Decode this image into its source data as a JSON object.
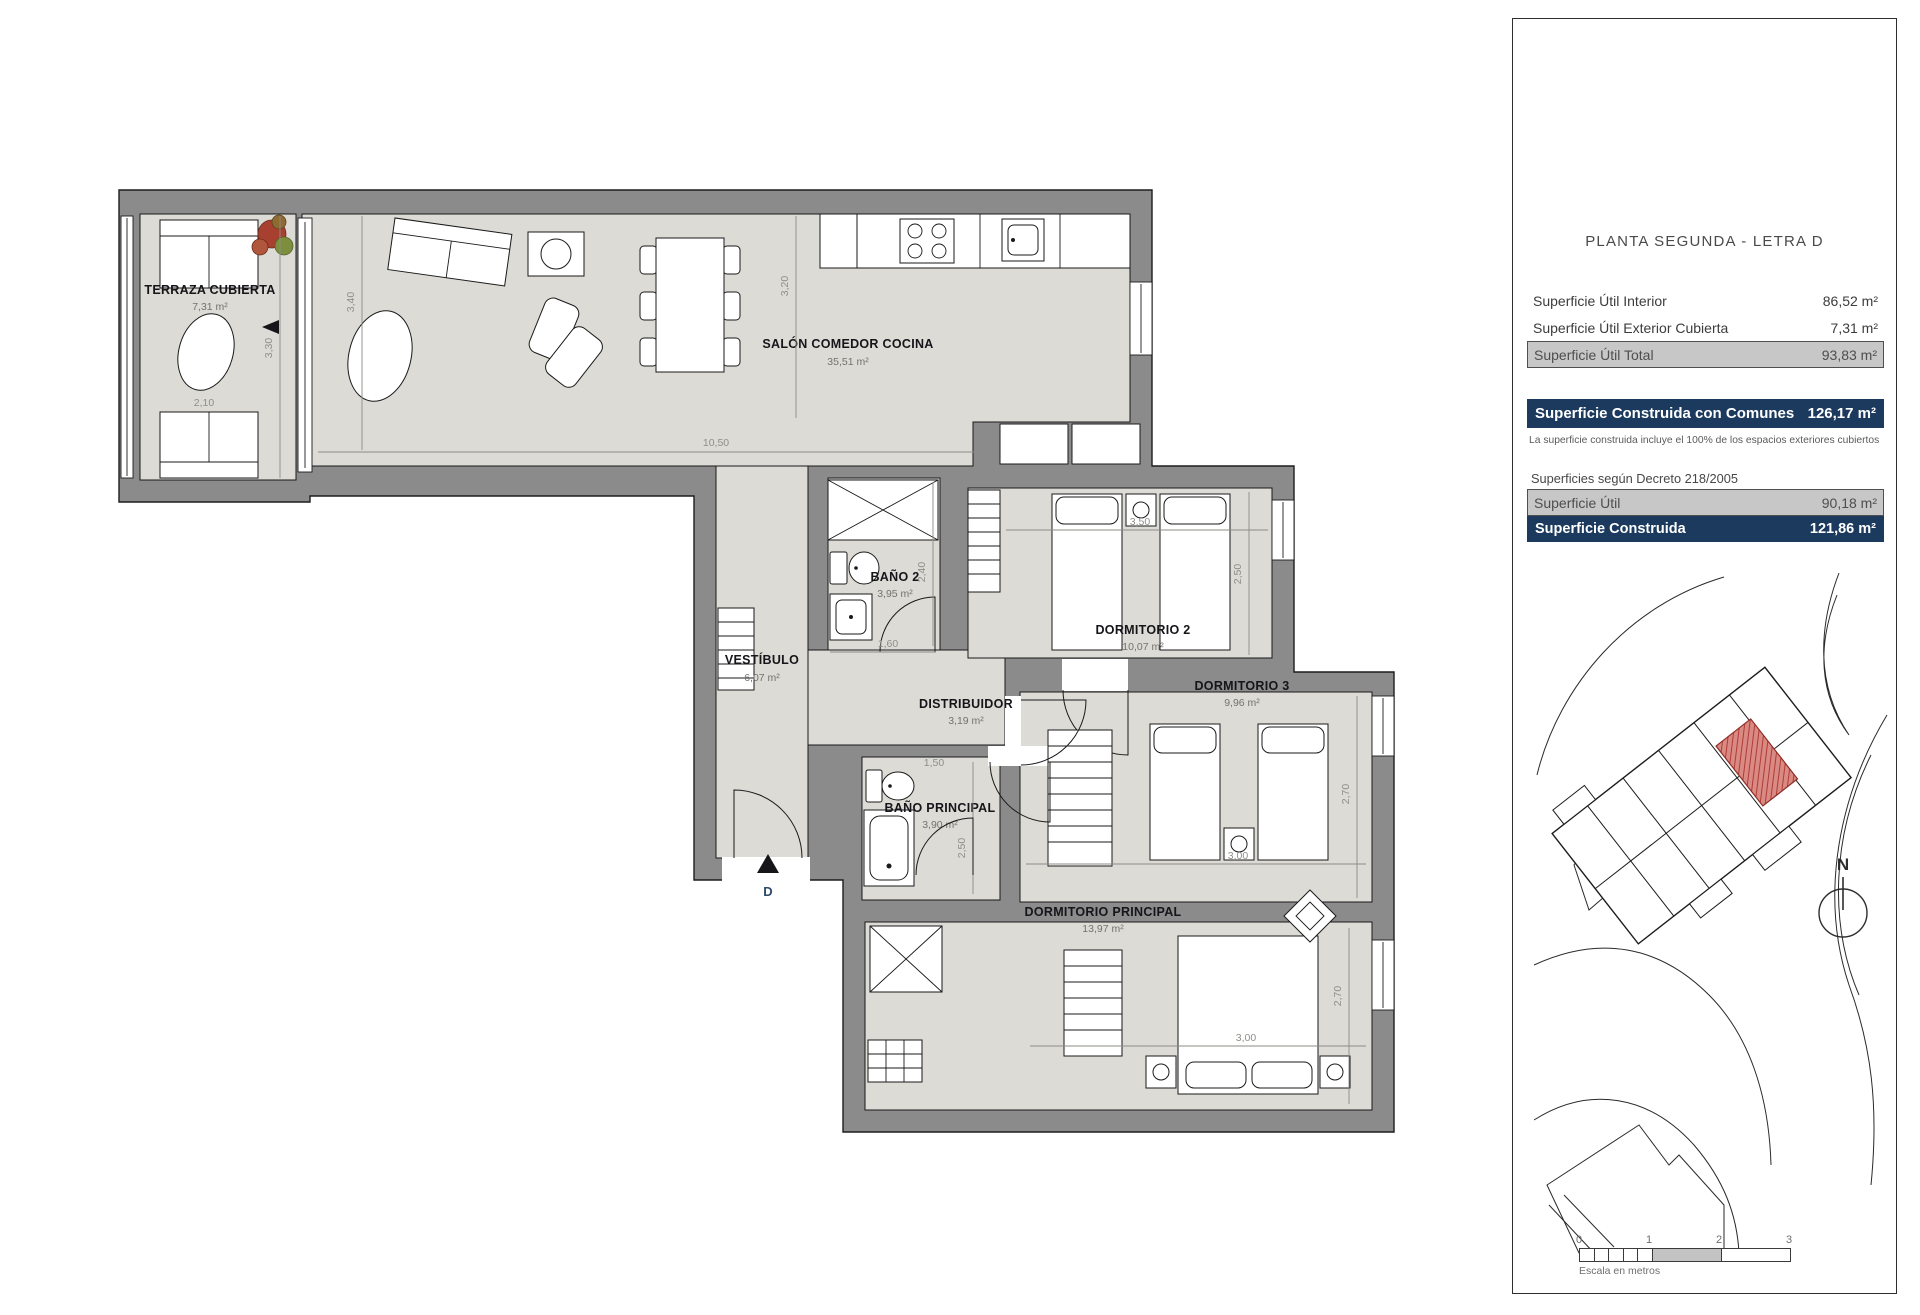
{
  "panel": {
    "title": "PLANTA SEGUNDA - LETRA D",
    "surface_rows": [
      {
        "label": "Superficie Útil Interior",
        "value": "86,52 m²"
      },
      {
        "label": "Superficie Útil Exterior Cubierta",
        "value": "7,31 m²"
      },
      {
        "label": "Superficie Útil Total",
        "value": "93,83 m²"
      }
    ],
    "construida_comunes": {
      "label": "Superficie Construida con Comunes",
      "value": "126,17 m²"
    },
    "note": "La superficie construida incluye el 100% de los espacios exteriores cubiertos",
    "decree_heading": "Superficies según Decreto 218/2005",
    "decree_rows": [
      {
        "label": "Superficie Útil",
        "value": "90,18 m²"
      },
      {
        "label": "Superficie Construida",
        "value": "121,86 m²"
      }
    ],
    "north_label": "N",
    "scale_bar": {
      "ticks": [
        "0",
        "1",
        "2",
        "3"
      ],
      "caption": "Escala en metros"
    }
  },
  "floorplan": {
    "entrance_label": "D",
    "rooms": {
      "terraza": {
        "name": "TERRAZA CUBIERTA",
        "area": "7,31 m²"
      },
      "salon": {
        "name": "SALÓN COMEDOR COCINA",
        "area": "35,51 m²"
      },
      "vestibulo": {
        "name": "VESTÍBULO",
        "area": "6,07 m²"
      },
      "bano2": {
        "name": "BAÑO 2",
        "area": "3,95 m²"
      },
      "distribuidor": {
        "name": "DISTRIBUIDOR",
        "area": "3,19 m²"
      },
      "dorm2": {
        "name": "DORMITORIO 2",
        "area": "10,07 m²"
      },
      "dorm3": {
        "name": "DORMITORIO 3",
        "area": "9,96 m²"
      },
      "banop": {
        "name": "BAÑO PRINCIPAL",
        "area": "3,90 m²"
      },
      "dormp": {
        "name": "DORMITORIO PRINCIPAL",
        "area": "13,97 m²"
      }
    },
    "dims": {
      "terraza_h": "3,30",
      "terraza_w": "2,10",
      "salon_w": "10,50",
      "salon_h": "3,40",
      "cocina_h": "3,20",
      "bano2_h": "2,40",
      "bano2_w": "1,60",
      "dorm2_w": "3,50",
      "dorm2_h": "2,50",
      "dorm3_w": "3,00",
      "dorm3_h": "2,70",
      "banop_w": "1,50",
      "banop_h": "2,50",
      "dormp_w": "3,00",
      "dormp_h": "2,70"
    }
  },
  "colors": {
    "navy": "#1b3a5e",
    "row_gray": "#c7c7c7",
    "wall_gray": "#8b8b8b",
    "floor_gray": "#dcdbd5",
    "unit_red": "#b03b33"
  }
}
